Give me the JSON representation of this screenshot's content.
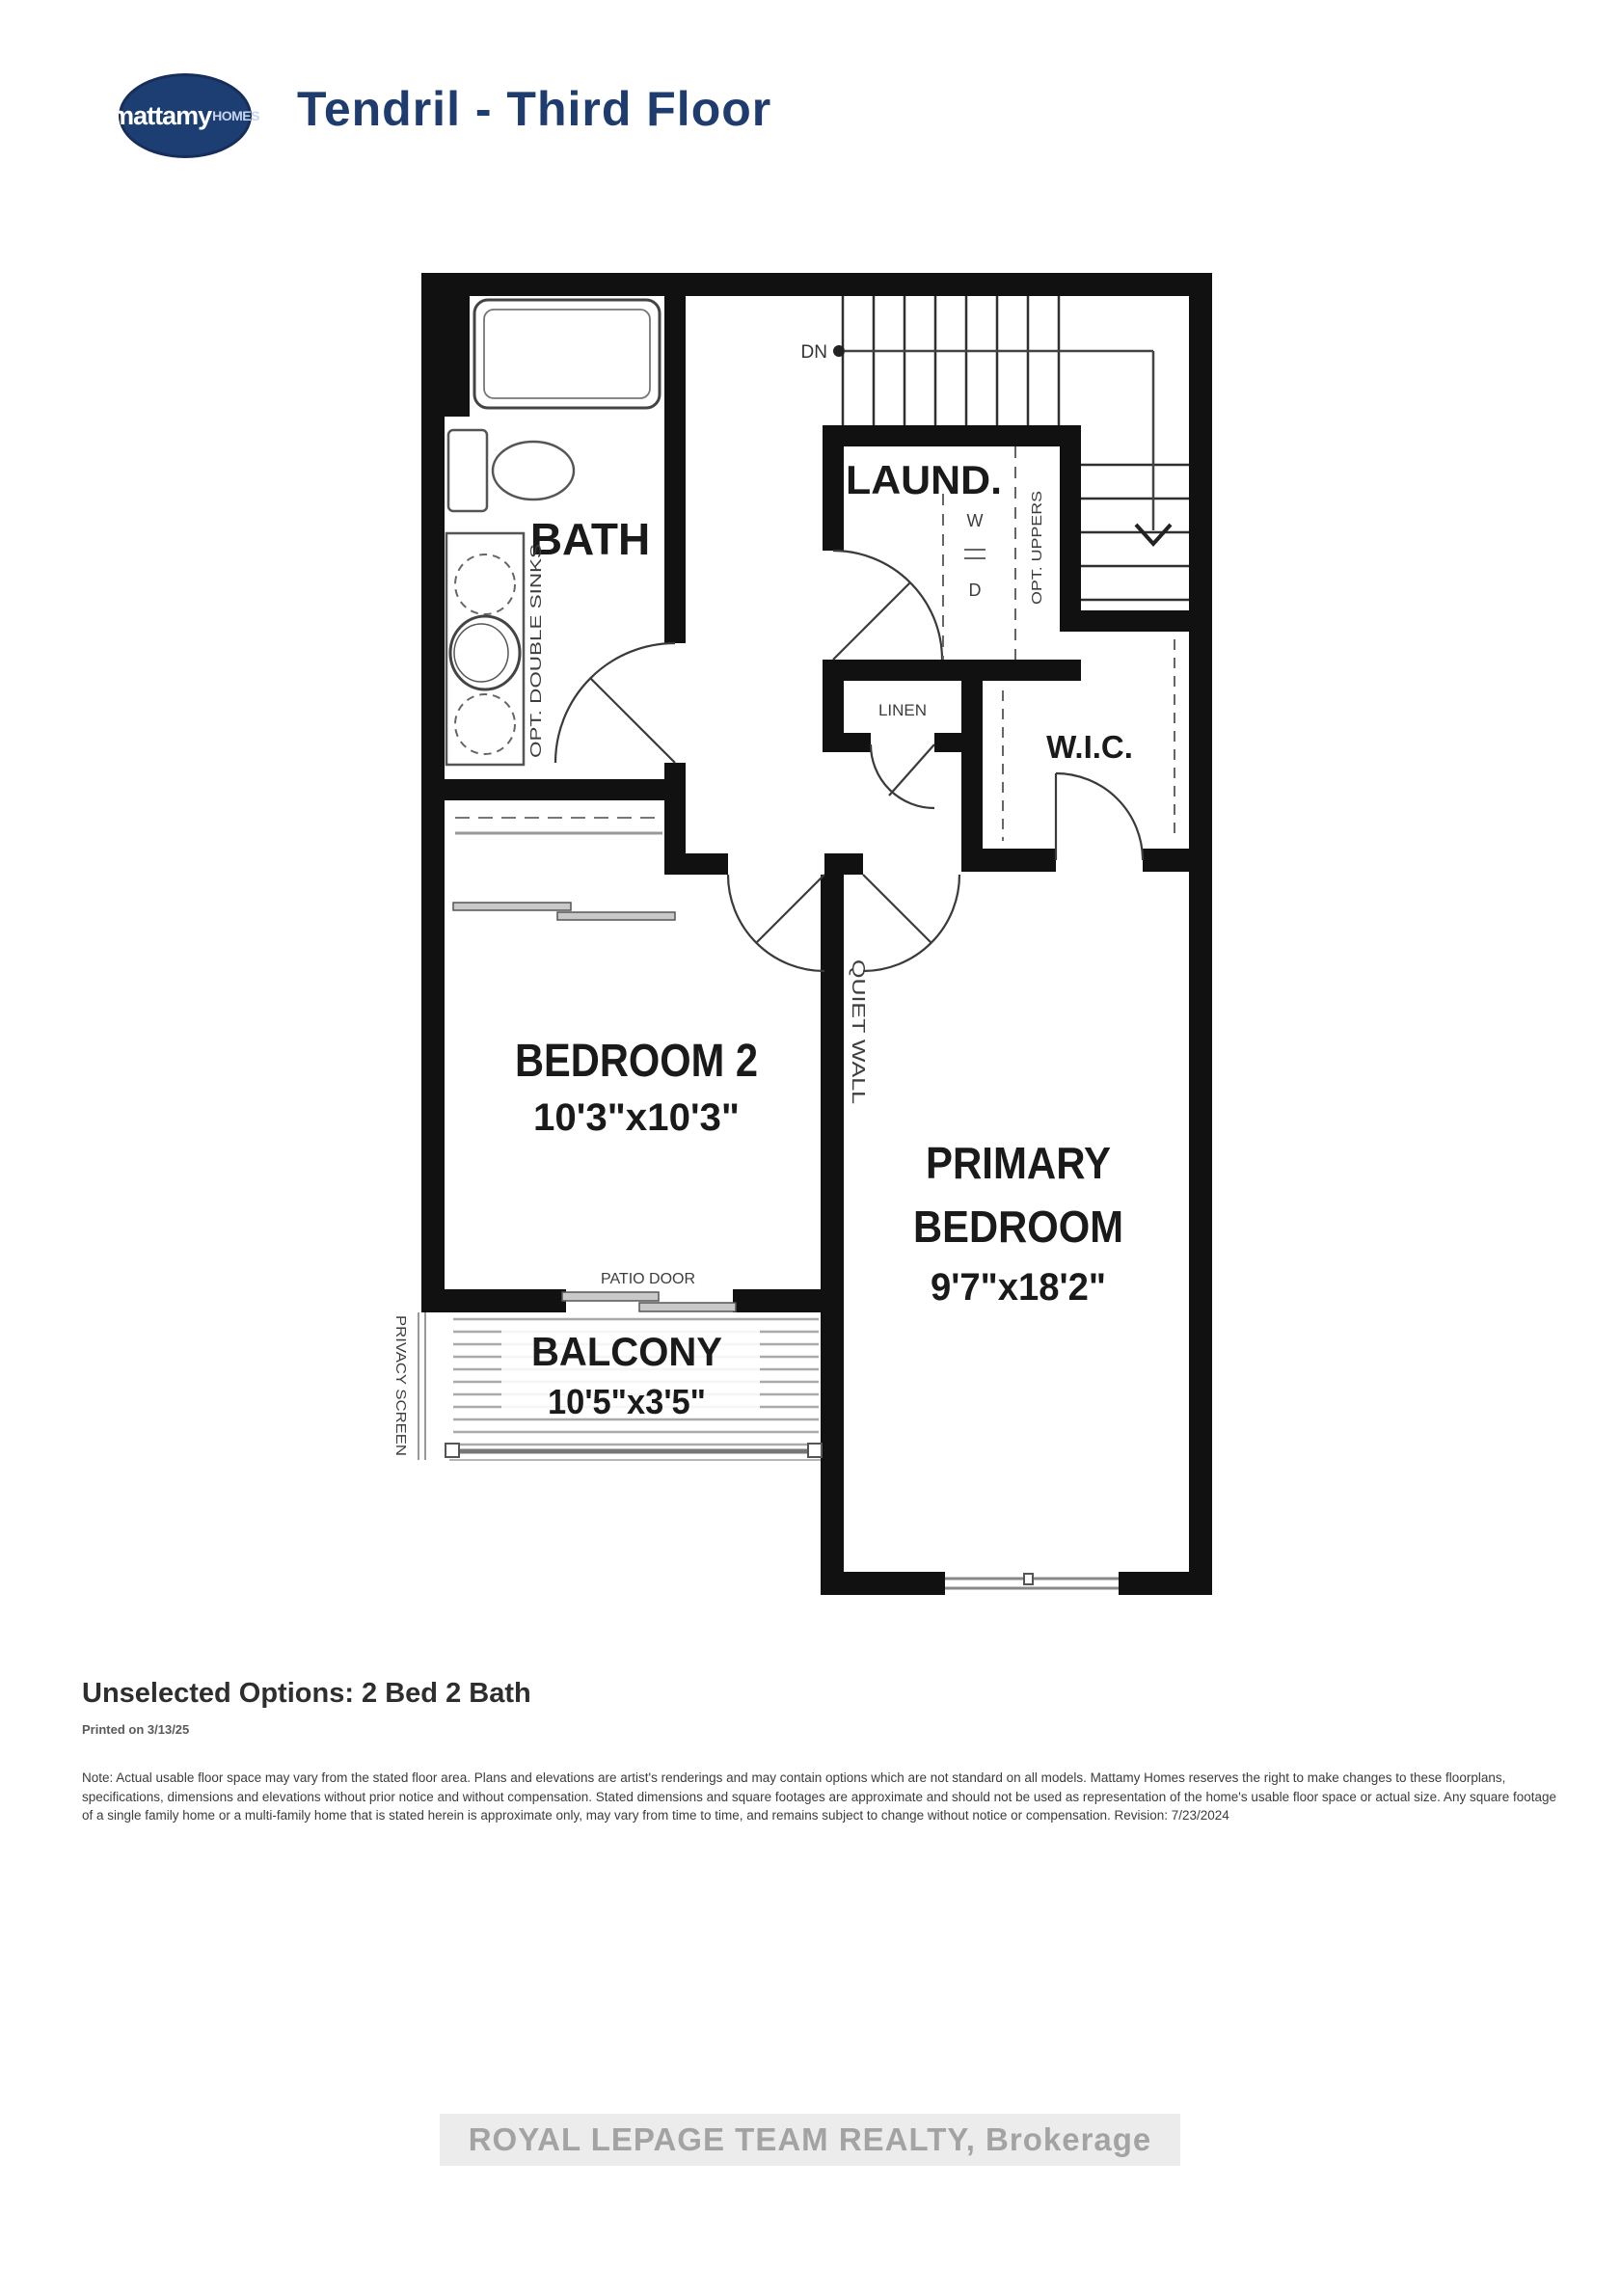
{
  "header": {
    "logo_primary": "mattamy",
    "logo_secondary": "HOMES",
    "title": "Tendril - Third Floor"
  },
  "plan": {
    "bath": {
      "label": "BATH",
      "opt_sinks": "OPT. DOUBLE SINKS"
    },
    "laundry": {
      "label": "LAUND.",
      "washer": "W",
      "dryer": "D",
      "opt_uppers": "OPT. UPPERS"
    },
    "linen": {
      "label": "LINEN"
    },
    "wic": {
      "label": "W.I.C."
    },
    "stairs": {
      "down": "DN"
    },
    "bedroom2": {
      "label": "BEDROOM 2",
      "dims": "10'3\"x10'3\""
    },
    "primary": {
      "label_line1": "PRIMARY",
      "label_line2": "BEDROOM",
      "dims": "9'7\"x18'2\"",
      "quiet_wall": "QUIET WALL"
    },
    "balcony": {
      "label": "BALCONY",
      "dims": "10'5\"x3'5\"",
      "privacy_screen": "PRIVACY SCREEN",
      "patio_door": "PATIO DOOR"
    }
  },
  "footer": {
    "unselected_options": "Unselected Options: 2 Bed 2 Bath",
    "printed": "Printed on 3/13/25",
    "disclaimer": "Note: Actual usable floor space may vary from the stated floor area. Plans and elevations are artist's renderings and may contain options which are not standard on all models. Mattamy Homes reserves the right to make changes to these floorplans, specifications, dimensions and elevations without prior notice and without compensation. Stated dimensions and square footages are approximate and should not be used as representation of the home's usable floor space or actual size. Any square footage of a single family home or a multi-family home that is stated herein is approximate only, may vary from time to time, and remains subject to change without notice or compensation. Revision: 7/23/2024"
  },
  "watermark": "ROYAL LEPAGE TEAM REALTY, Brokerage",
  "colors": {
    "brand_navy": "#1e3c6e",
    "wall_black": "#111111"
  }
}
